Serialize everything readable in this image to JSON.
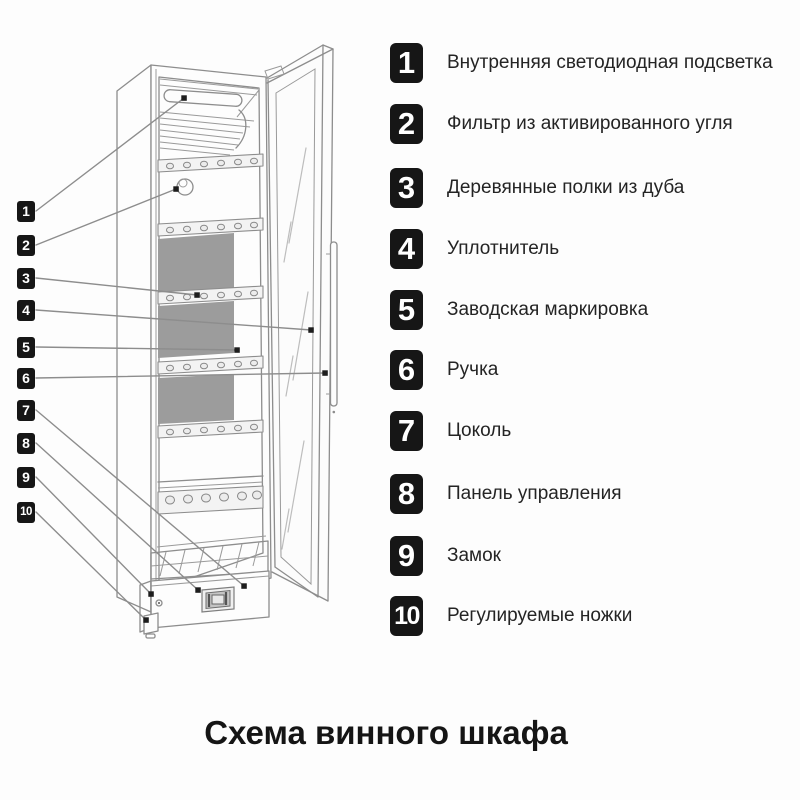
{
  "title": "Схема винного шкафа",
  "legend": {
    "items": [
      {
        "number": "1",
        "label": "Внутренняя светодиодная подсветка"
      },
      {
        "number": "2",
        "label": "Фильтр из активированного угля"
      },
      {
        "number": "3",
        "label": "Деревянные полки из дуба"
      },
      {
        "number": "4",
        "label": "Уплотнитель"
      },
      {
        "number": "5",
        "label": "Заводская маркировка"
      },
      {
        "number": "6",
        "label": "Ручка"
      },
      {
        "number": "7",
        "label": "Цоколь"
      },
      {
        "number": "8",
        "label": "Панель управления"
      },
      {
        "number": "9",
        "label": "Замок"
      },
      {
        "number": "10",
        "label": "Регулируемые ножки"
      }
    ]
  },
  "colors": {
    "background": "#fdfdfd",
    "badge_background": "#161616",
    "badge_text": "#ffffff",
    "line_art": "#8d8d8d",
    "shelf_panel_gray": "#9c9c9c",
    "text": "#242424"
  }
}
